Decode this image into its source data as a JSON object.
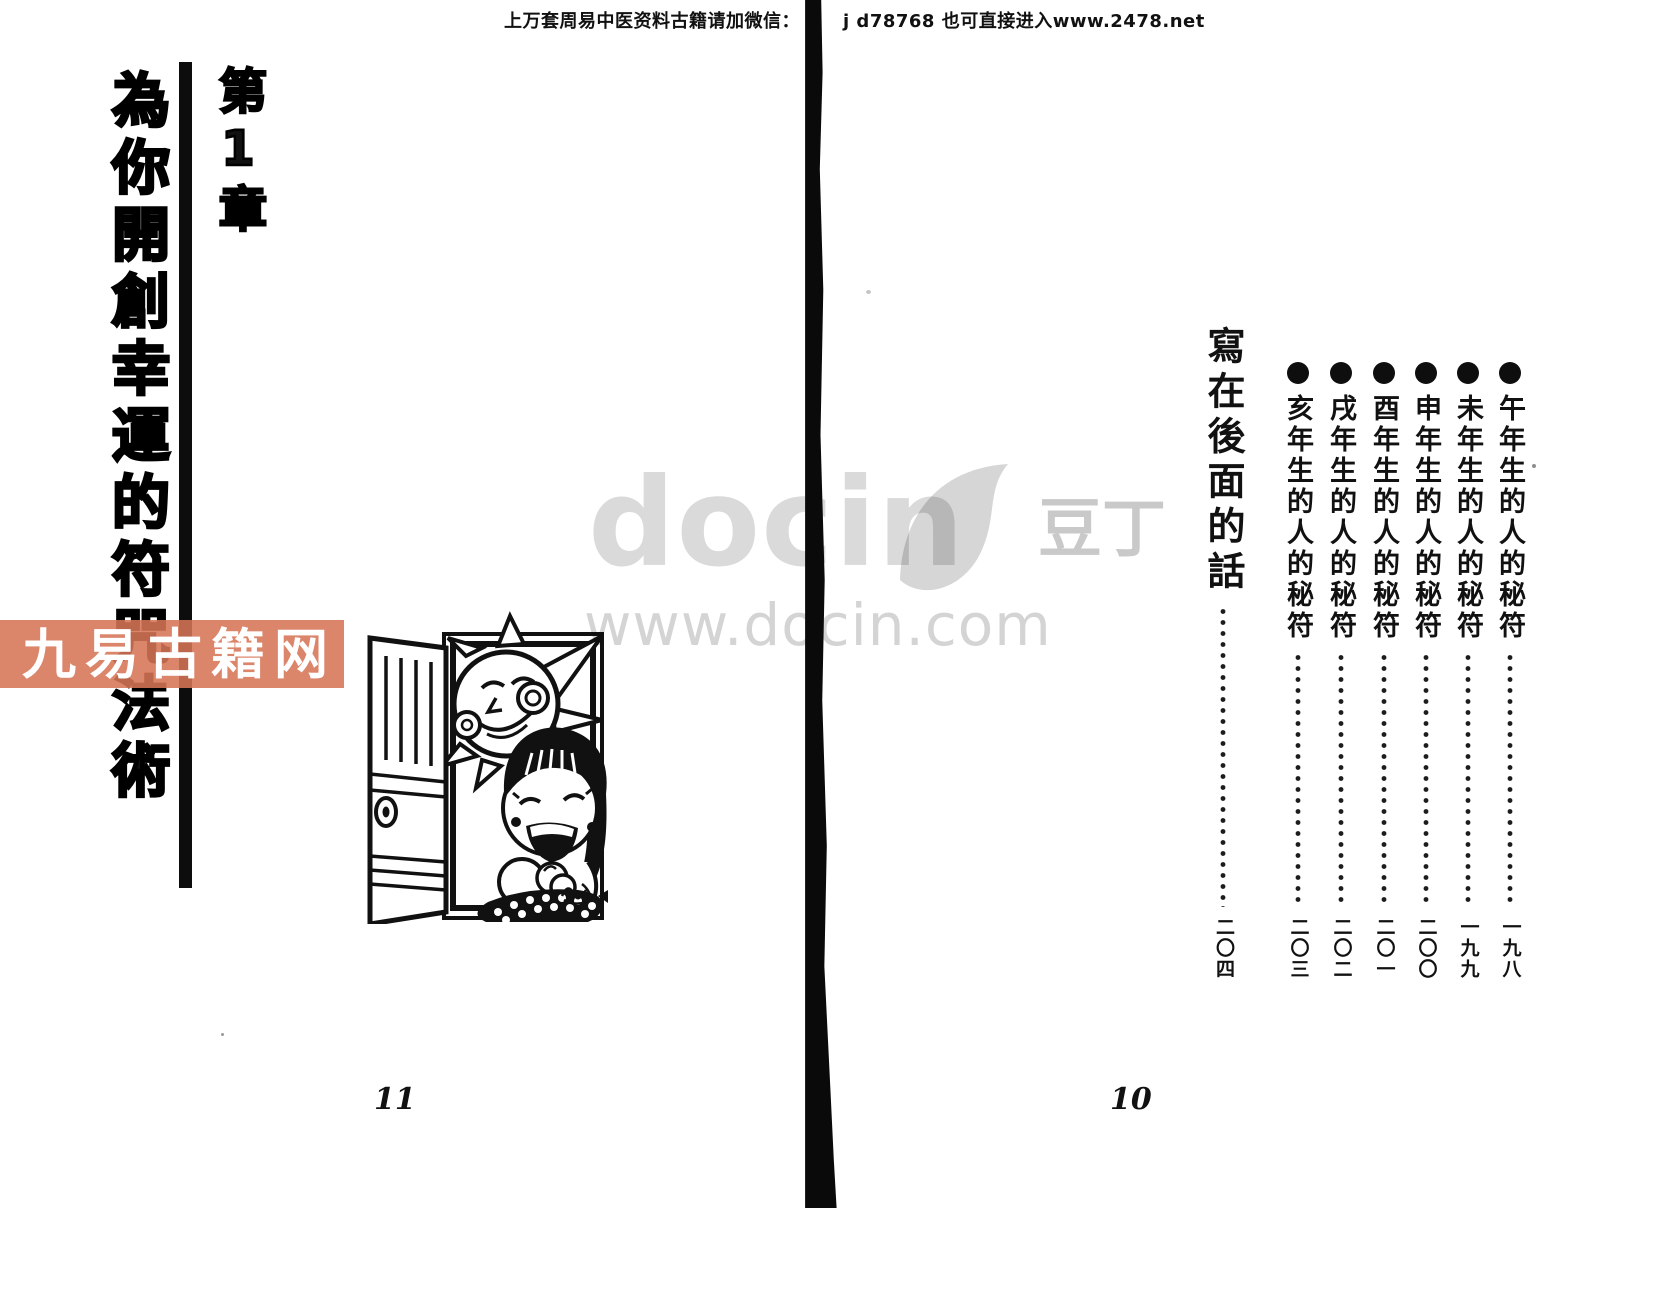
{
  "header": {
    "notice_left": "上万套周易中医资料古籍请加微信：",
    "notice_right": "j d78768  也可直接进入www.2478.net"
  },
  "left_page": {
    "chapter_label": "第1章",
    "title": "為你開創幸運的符咒法術",
    "page_number": "11",
    "illustration_name": "sun-and-girl-at-open-door"
  },
  "right_page": {
    "toc_entries": [
      {
        "label": "午年生的人的秘符",
        "page": "一九八"
      },
      {
        "label": "未年生的人的秘符",
        "page": "一九九"
      },
      {
        "label": "申年生的人的秘符",
        "page": "二〇〇"
      },
      {
        "label": "酉年生的人的秘符",
        "page": "二〇一"
      },
      {
        "label": "戌年生的人的秘符",
        "page": "二〇二"
      },
      {
        "label": "亥年生的人的秘符",
        "page": "二〇三"
      }
    ],
    "closing_entry": {
      "label": "寫在後面的話",
      "page": "二〇四"
    },
    "page_number": "10"
  },
  "watermarks": {
    "red_banner_text": "九易古籍网",
    "red_banner_color": "#d67456",
    "docin_logo_text": "docin",
    "docin_cn_text": "豆丁",
    "docin_url_text": "www.docin.com",
    "gray_color": "#d6d6d6"
  }
}
